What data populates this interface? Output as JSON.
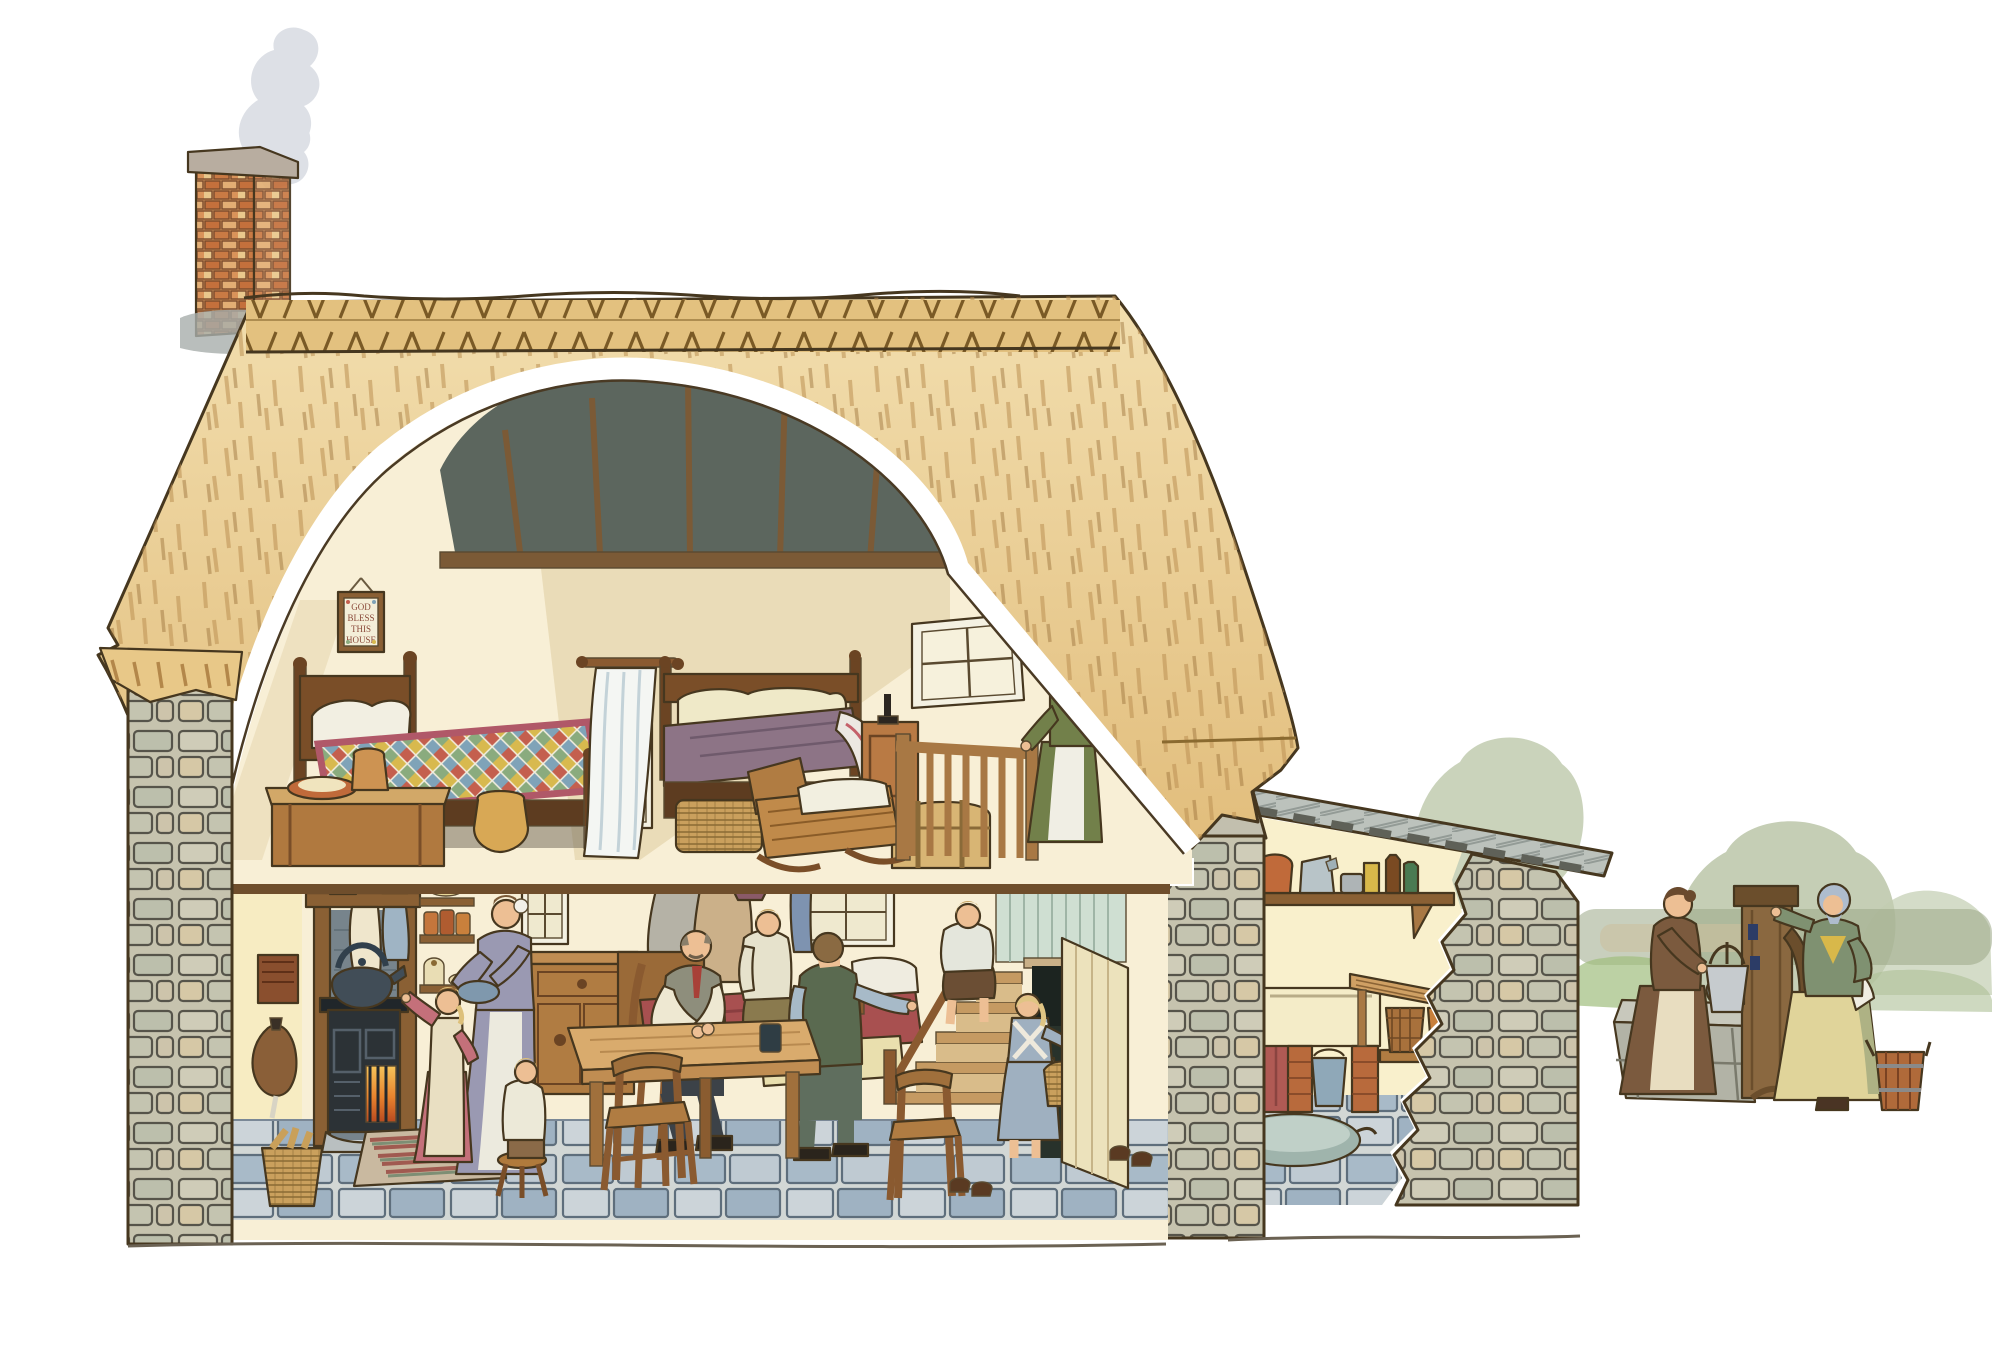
{
  "meta": {
    "title": "Thatched cottage cutaway illustration",
    "style": "pen-and-ink with watercolour wash",
    "background_color": "#ffffff"
  },
  "sampler": {
    "lines": [
      "GOD",
      "BLESS",
      "THIS",
      "HOUSE"
    ]
  },
  "rooms": {
    "attic_bedroom": {
      "label": "Attic bedroom",
      "objects": [
        "framed sampler",
        "child's bed with patchwork quilt",
        "white pillows",
        "wooden chest with jug and bowl on lid",
        "earthenware jug on floor",
        "divider curtain on wooden pole",
        "small casement window",
        "parents' bed with mauve coverlet",
        "wicker basket under bed",
        "wooden rocking cradle with bedding",
        "bedside cupboard with candlestick",
        "dome-topped travelling trunk",
        "stair railing with turned spindles",
        "dormer casement window",
        "exposed rafters and purlins"
      ],
      "people": [
        "mother in green dress holding a swaddled baby at the stair rail"
      ]
    },
    "kitchen_living_room": {
      "label": "Kitchen and living room",
      "objects": [
        "hanging candle box",
        "bellows on wall",
        "wicker log basket",
        "mantel shelf with mug and jug",
        "towels drying on mantel",
        "black cast-iron range with glowing fire",
        "large kettle",
        "shelves of crocks and bowls",
        "dresser sideboard with drawers",
        "striped rag rug",
        "three-legged stool",
        "small four-pane window",
        "coat pegs with coats and hat",
        "window with blue curtain",
        "day bed with red cover and pillows",
        "scrubbed kitchen table",
        "glass tumbler",
        "wooden chairs",
        "staircase with handrail",
        "plank door standing open",
        "boots and shoes on flagstone floor"
      ],
      "people": [
        "mother holding a mixing bowl",
        "girl in pinafore reaching to the range",
        "toddler sitting on a stool",
        "father seated at the table",
        "boy sitting on the day bed",
        "young man seated with his back turned",
        "boy sitting on the stairs",
        "small girl carrying a basket through the doorway"
      ]
    },
    "scullery": {
      "label": "Lean-to scullery",
      "objects": [
        "boarded lean-to roof with rafter ends",
        "shelf with storage crock, enamel jug, tin, box, brown bottle and green bottle",
        "shelf bracket",
        "slatted work bench",
        "stone sink",
        "red curtain below sink",
        "brick piers",
        "enamel pail",
        "coopered washtub",
        "stoneware jar",
        "oval tin bath",
        "cutaway rubble stone wall"
      ]
    },
    "yard": {
      "label": "Yard",
      "objects": [
        "wooden village pump with curved handle and spout",
        "timber water trough box",
        "metal pail on trough",
        "coopered wooden bucket",
        "soft trees and hedgerow"
      ],
      "people": [
        "woman in brown dress lifting a pail from the trough",
        "woman in blue headscarf and yellow skirt resting a hand on the pump"
      ]
    },
    "exterior": {
      "label": "Exterior",
      "objects": [
        "brick chimney stack with rising smoke",
        "deep thatched roof",
        "decorative thatch ridge with hazel-spar zigzags",
        "cut stone gable walls",
        "white cutaway band revealing the interior",
        "first-floor joist ends",
        "ground line"
      ]
    }
  },
  "palette": {
    "thatch_light": "#f2deae",
    "thatch_mid": "#e2bf7e",
    "thatch_stroke": "#b3874a",
    "ridge_spar": "#7a5a26",
    "brick": "#c8743f",
    "stone": "#c6c3ae",
    "wood_dark": "#7a4e28",
    "wood_mid": "#b07c42",
    "wood_light": "#d2a868",
    "flagstone_blue": "#a8bac8",
    "quilt_red": "#c45f4e",
    "quilt_blue": "#7fa3b8",
    "quilt_yellow": "#d8b94e",
    "quilt_green": "#8aab7e",
    "coverlet_mauve": "#8d7486",
    "range_black": "#2c3236",
    "fire_orange": "#e8832e",
    "curtain_red": "#b05a54",
    "dress_green": "#72804a",
    "dress_lavender": "#9a99b2",
    "skirt_yellow": "#e0d49a",
    "foliage_sage": "#b6c2a2",
    "smoke_grey": "#c7ccd6",
    "interior_cream": "#f8efd6",
    "wall_yellow": "#f7ecc2"
  }
}
